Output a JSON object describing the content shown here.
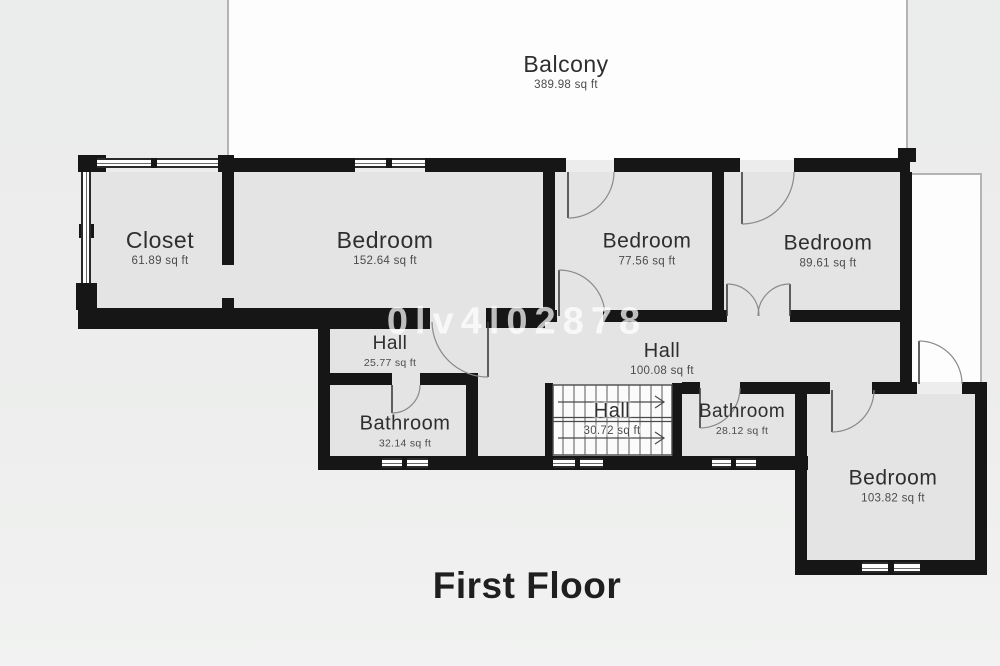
{
  "title": "First Floor",
  "watermark": "0lv4l02878",
  "rooms": {
    "balcony": {
      "name": "Balcony",
      "area": "389.98 sq ft"
    },
    "closet": {
      "name": "Closet",
      "area": "61.89 sq ft"
    },
    "bedroom_main": {
      "name": "Bedroom",
      "area": "152.64 sq ft"
    },
    "bedroom_mid": {
      "name": "Bedroom",
      "area": "77.56 sq ft"
    },
    "bedroom_right": {
      "name": "Bedroom",
      "area": "89.61 sq ft"
    },
    "hall_small": {
      "name": "Hall",
      "area": "25.77 sq ft"
    },
    "hall_main": {
      "name": "Hall",
      "area": "100.08 sq ft"
    },
    "hall_stairs": {
      "name": "Hall",
      "area": "30.72 sq ft"
    },
    "bathroom_left": {
      "name": "Bathroom",
      "area": "32.14 sq ft"
    },
    "bathroom_right": {
      "name": "Bathroom",
      "area": "28.12 sq ft"
    },
    "bedroom_bottom": {
      "name": "Bedroom",
      "area": "103.82 sq ft"
    }
  },
  "colors": {
    "wall": "#161616",
    "room_fill": "#e3e4e3",
    "outdoor_fill": "#fdfdfd",
    "background": "#ecedec"
  }
}
